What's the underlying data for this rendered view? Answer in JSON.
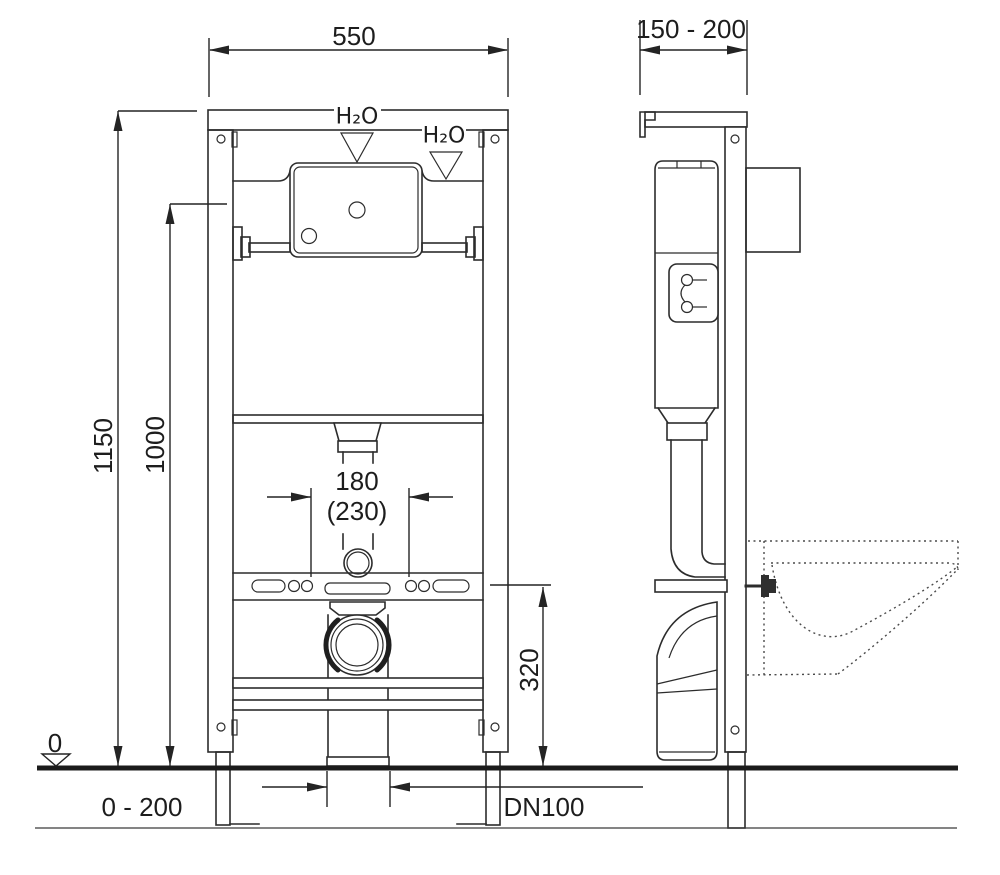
{
  "drawing": {
    "background_color": "#ffffff",
    "line_color": "#2c2c2c",
    "front_view": {
      "width": "550",
      "total_height": "1150",
      "upper_height": "1000",
      "water_supply_primary": "H₂O",
      "water_supply_alternate": "H₂O",
      "center_spacing": "180",
      "center_spacing_alt": "(230)",
      "outlet_height": "320",
      "datum_level": "0",
      "foot_adjustment_range": "0 - 200",
      "drain_diameter": "DN100"
    },
    "side_view": {
      "mounting_depth_range": "150 - 200"
    }
  }
}
